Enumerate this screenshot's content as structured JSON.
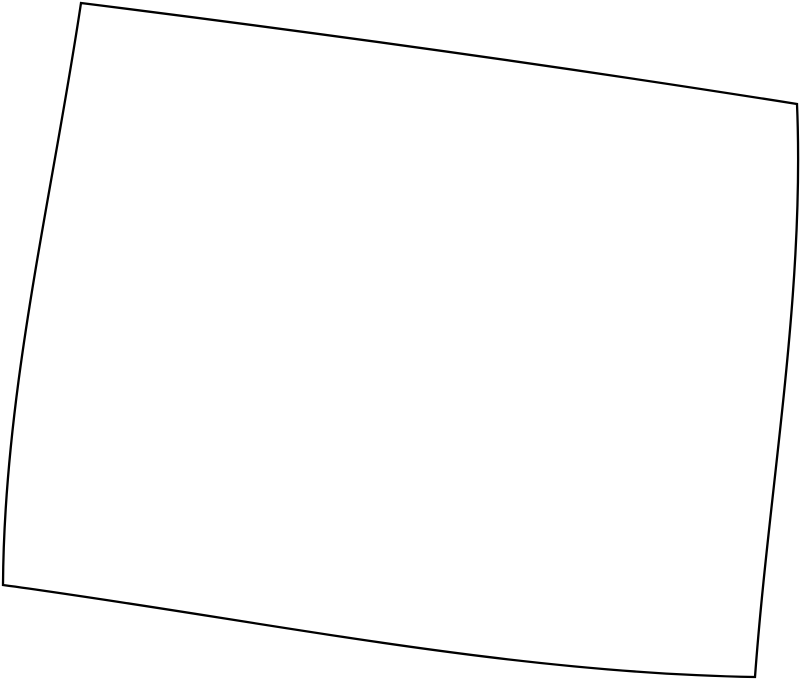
{
  "map": {
    "type": "blank-state-outline-map",
    "outline_path": "M 81 3 C 320 33 558 66 797 104 C 805 295 769 486 755 677 C 504 673 254 619 3 585 C 4 391 52 197 81 3 Z",
    "outline_color": "#000000",
    "fill_color": "#ffffff",
    "background_color": "#ffffff",
    "stroke_width": "2.3"
  }
}
